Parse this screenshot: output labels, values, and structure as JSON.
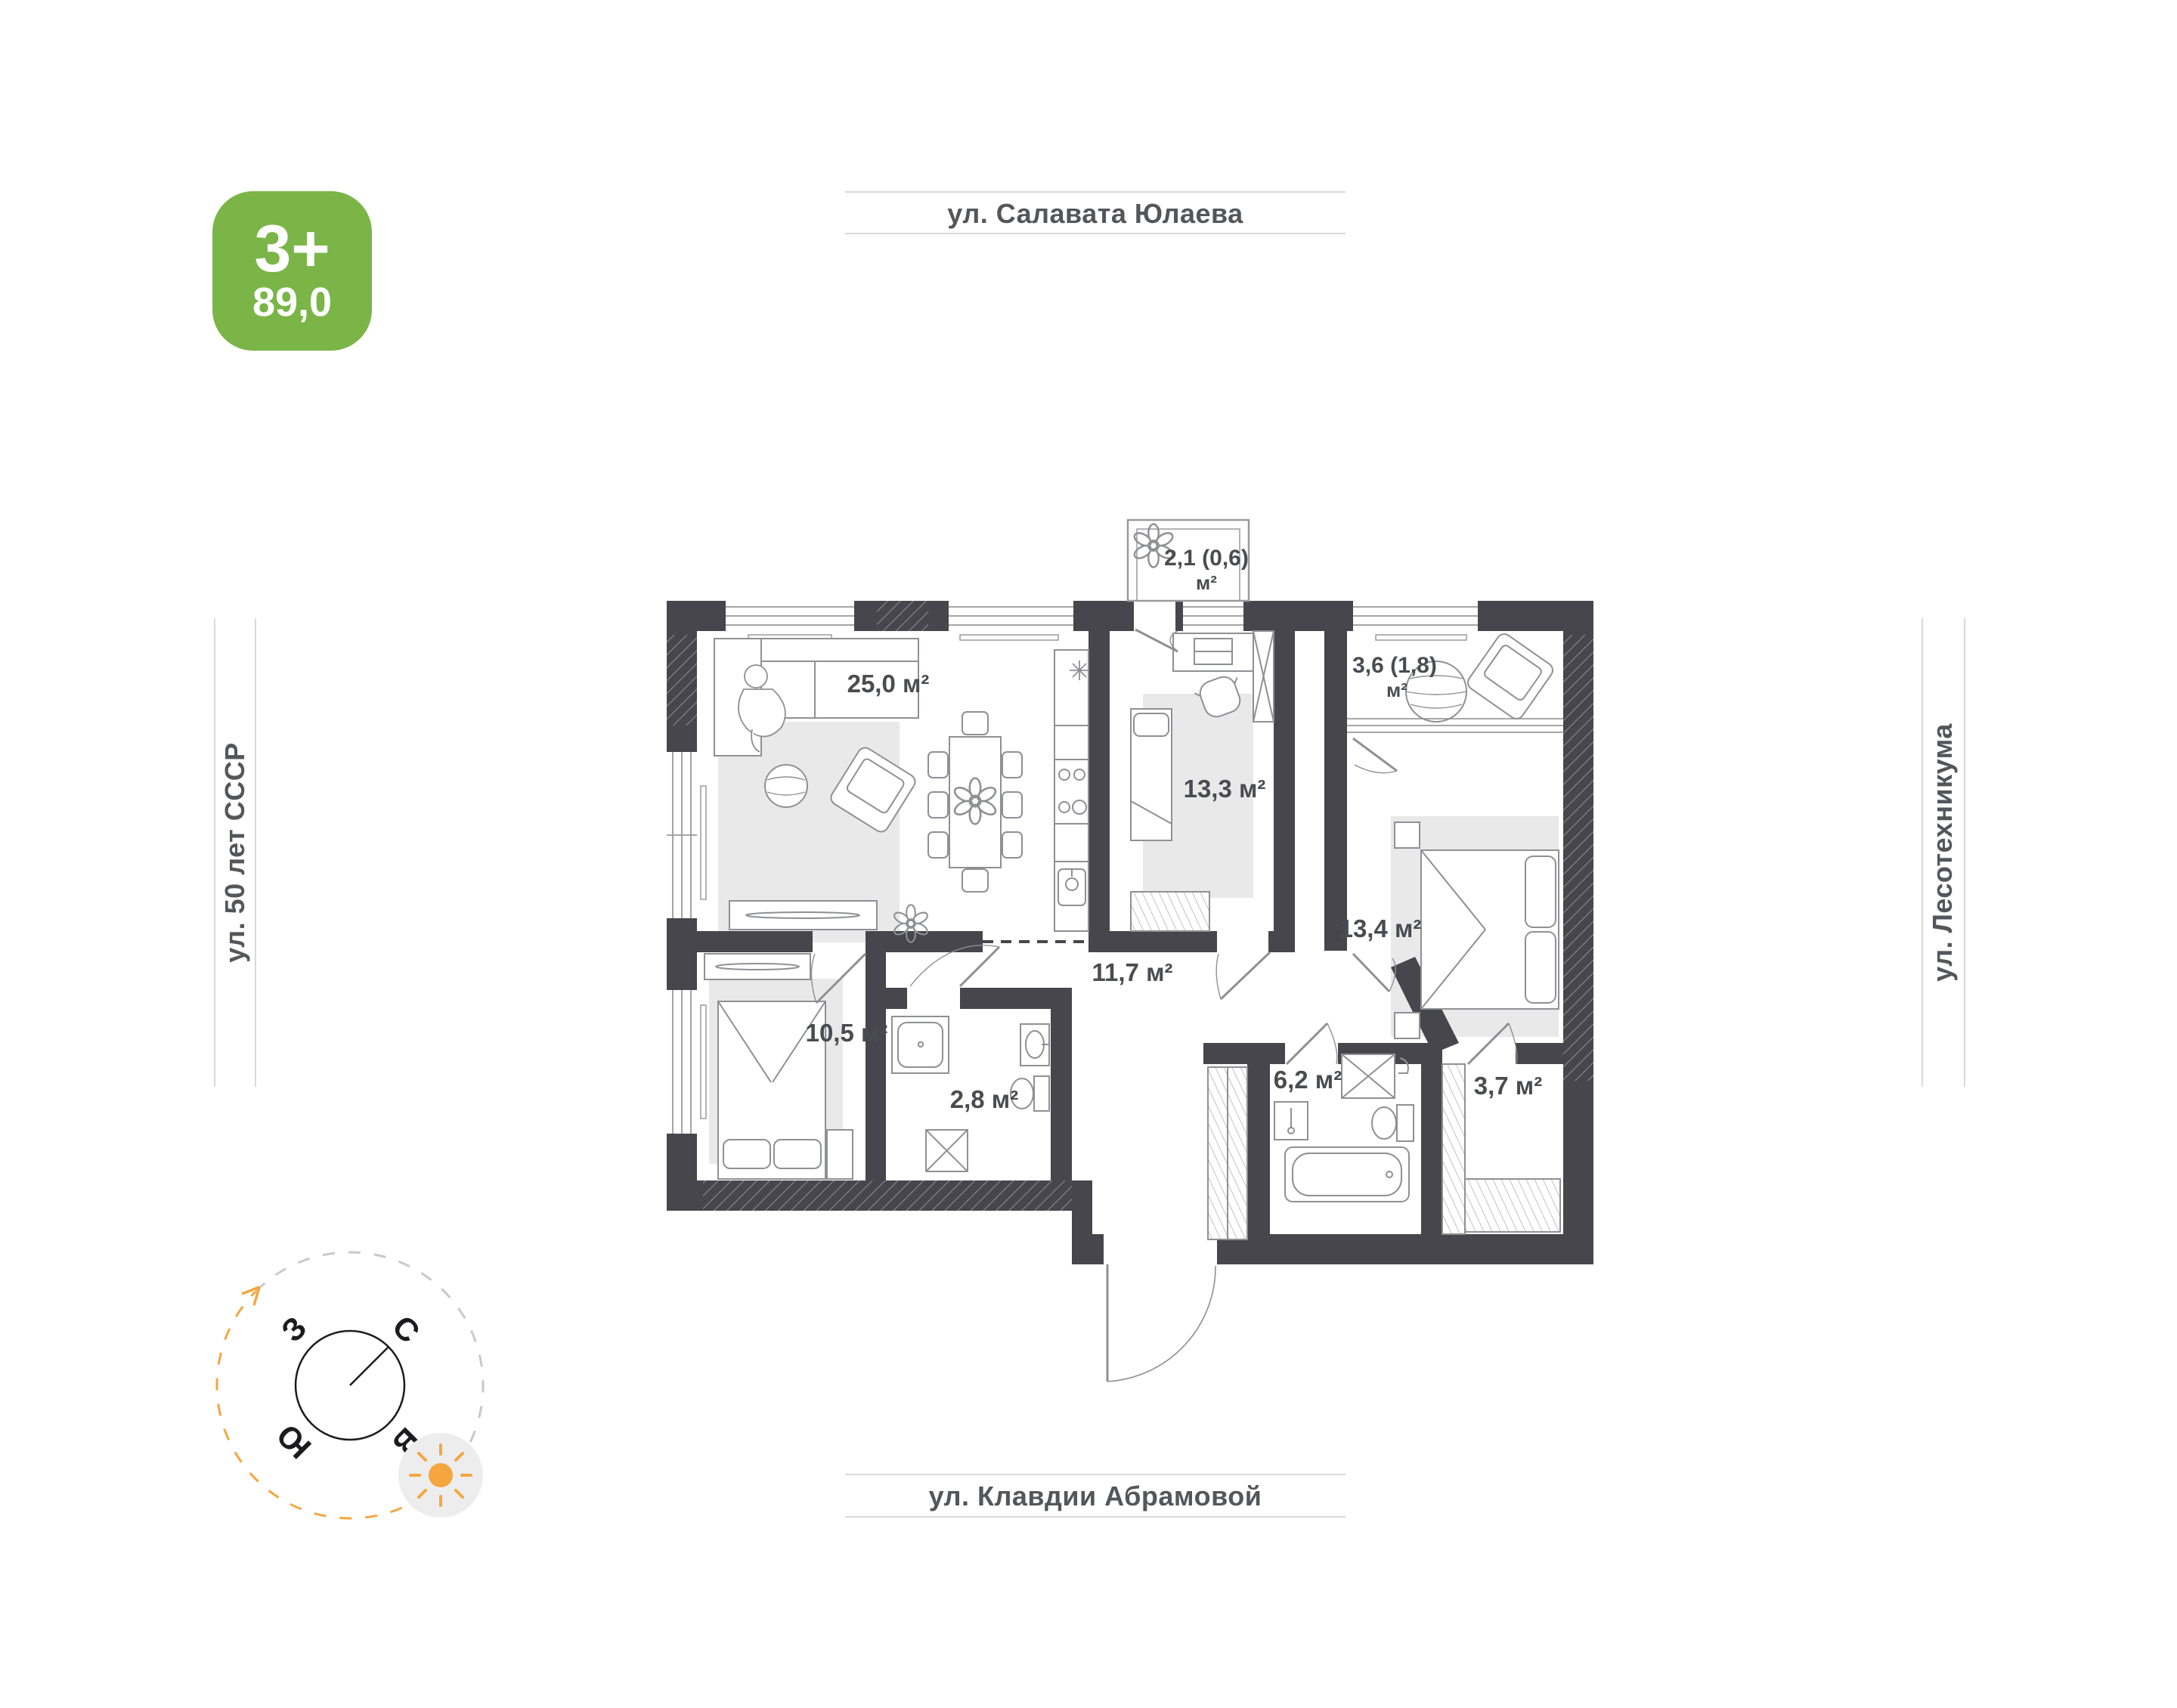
{
  "badge": {
    "rooms": "3+",
    "area": "89,0"
  },
  "streets": {
    "top": "ул. Салавата Юлаева",
    "bottom": "ул. Клавдии Абрамовой",
    "left": "ул. 50 лет СССР",
    "right": "ул. Лесотехникума"
  },
  "rooms": {
    "living": {
      "label": "25,0 м²"
    },
    "bedroom2": {
      "label": "13,3 м²"
    },
    "loggia": {
      "label": "3,6 (1,8)",
      "unit": "м²"
    },
    "bedroom3": {
      "label": "13,4 м²"
    },
    "corridor": {
      "label": "11,7 м²"
    },
    "bedroom1": {
      "label": "10,5 м²"
    },
    "shower": {
      "label": "2,8 м²"
    },
    "bathroom": {
      "label": "6,2 м²"
    },
    "wardrobe": {
      "label": "3,7 м²"
    },
    "balcony": {
      "label": "2,1 (0,6)",
      "unit": "м²"
    }
  },
  "compass": {
    "north": "С",
    "south": "Ю",
    "west": "З",
    "east": "В"
  },
  "colors": {
    "accent_green": "#7bb548",
    "wall_dark": "#46464c",
    "sun_orange": "#f6a63f",
    "furniture_gray": "#8f9094"
  }
}
